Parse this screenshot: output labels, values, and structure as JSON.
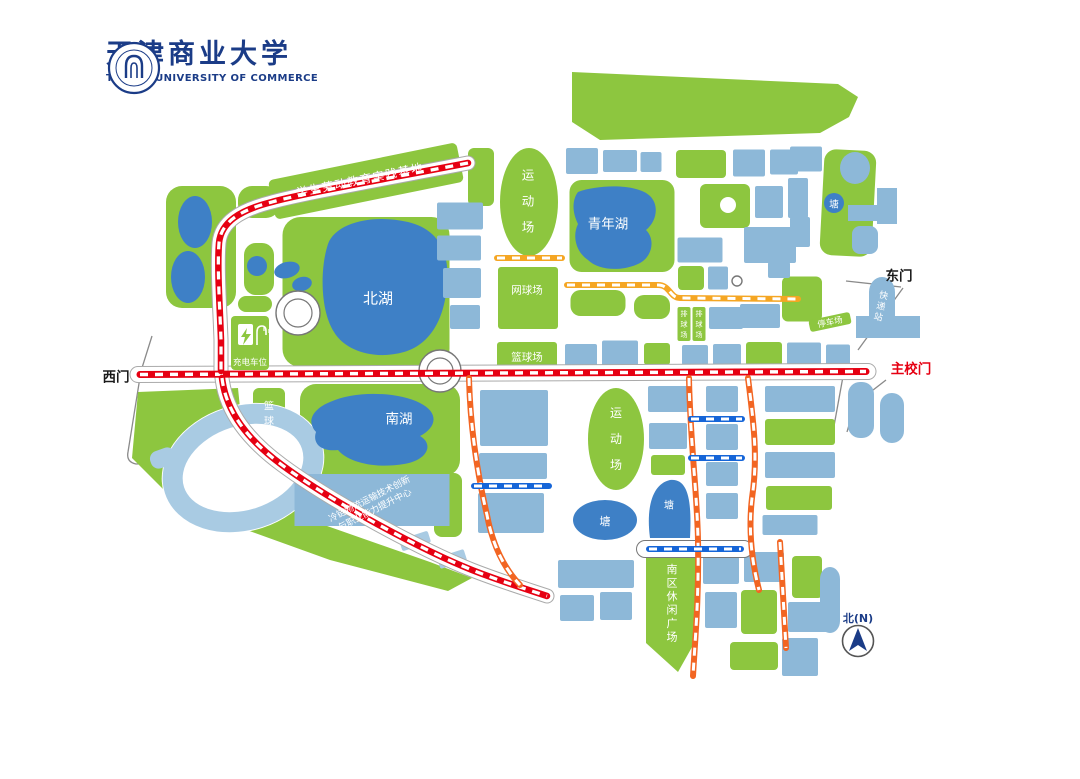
{
  "logo": {
    "title": "天津商业大学",
    "subtitle": "TIANJIN UNIVERSITY OF COMMERCE",
    "color": "#1b3c87"
  },
  "palette": {
    "green": "#8dc63f",
    "building": "#8db8d8",
    "lake": "#3e80c6",
    "lightblue": "#a9cbe3",
    "red": "#e60012",
    "orange": "#f26522",
    "yellow": "#f5a623",
    "routeBlue": "#1565d8",
    "boundary": "#8a8a8a",
    "roadEdge": "#aaaaaa",
    "navy": "#1b3c87",
    "textDark": "#1a1a1a"
  },
  "map": {
    "boundary": [
      "M152,336 L141,371 L128,452 Q126,462 136,464 L166,463",
      "M903,288 L858,350",
      "M846,281 L901,287",
      "M886,380 L855,404 L847,432",
      "M846,360 L834,426"
    ],
    "greens": {
      "polys": [
        "572,72 838,84 858,97 849,117 820,133 600,140 572,122",
        "138,392 238,388 246,468 310,520 430,562 472,578 448,591 330,560 180,506 132,458",
        "646,558 696,558 696,640 678,672 646,643"
      ],
      "rects": [
        [
          201,
          247,
          70,
          122,
          16,
          0
        ],
        [
          259,
          202,
          42,
          32,
          14,
          0
        ],
        [
          259,
          269,
          30,
          52,
          12,
          0
        ],
        [
          255,
          304,
          34,
          16,
          8,
          0
        ],
        [
          366,
          181,
          192,
          40,
          5,
          -11.5
        ],
        [
          481,
          177,
          26,
          58,
          6,
          0
        ],
        [
          366,
          292,
          167,
          150,
          18,
          0
        ],
        [
          528,
          298,
          60,
          62,
          3,
          0
        ],
        [
          527,
          356,
          60,
          28,
          3,
          0
        ],
        [
          622,
          226,
          105,
          92,
          12,
          0
        ],
        [
          598,
          303,
          55,
          26,
          10,
          0
        ],
        [
          652,
          307,
          36,
          24,
          10,
          0
        ],
        [
          269,
          422,
          32,
          68,
          6,
          0
        ],
        [
          380,
          430,
          160,
          92,
          16,
          0
        ],
        [
          448,
          505,
          28,
          64,
          8,
          0
        ],
        [
          725,
          206,
          50,
          44,
          6,
          0
        ],
        [
          691,
          278,
          26,
          24,
          4,
          0
        ],
        [
          802,
          299,
          40,
          45,
          6,
          0
        ],
        [
          848,
          203,
          52,
          106,
          12,
          3
        ],
        [
          701,
          164,
          50,
          28,
          4,
          0
        ],
        [
          657,
          354,
          26,
          22,
          3,
          0
        ],
        [
          764,
          354,
          36,
          24,
          3,
          0
        ],
        [
          668,
          465,
          34,
          20,
          3,
          0
        ],
        [
          800,
          432,
          70,
          26,
          3,
          0
        ],
        [
          799,
          498,
          66,
          24,
          3,
          0
        ],
        [
          807,
          577,
          30,
          42,
          4,
          0
        ],
        [
          759,
          612,
          36,
          44,
          4,
          0
        ],
        [
          754,
          656,
          48,
          28,
          4,
          0
        ]
      ],
      "ellipses": [
        [
          529,
          202,
          29,
          54
        ],
        [
          616,
          439,
          28,
          51
        ]
      ]
    },
    "water": {
      "lakes": [
        "M328,244 C336,222 374,214 408,222 C438,229 450,252 447,284 C445,316 432,344 404,352 C376,360 346,352 334,332 C320,310 320,268 328,244 Z",
        "M330,402 C356,390 398,392 420,403 C440,413 436,428 420,436 C434,444 428,460 404,464 C374,469 348,462 338,450 C322,452 312,444 316,432 C305,420 315,408 330,402 Z",
        "M578,192 C600,184 638,184 650,196 C660,206 656,222 646,230 C656,240 652,258 638,264 C620,272 598,270 588,260 C576,252 572,236 578,224 C572,212 572,200 578,192 Z",
        "M650,538 C646,508 652,484 670,480 C688,478 692,500 690,538 Z"
      ],
      "ellipses": [
        [
          605,
          520,
          32,
          20,
          0
        ],
        [
          195,
          222,
          17,
          26,
          0
        ],
        [
          188,
          277,
          17,
          26,
          0
        ],
        [
          287,
          270,
          13,
          8,
          -15
        ],
        [
          302,
          284,
          10,
          7,
          -15
        ]
      ],
      "circles": [
        [
          834,
          203,
          10
        ],
        [
          257,
          266,
          10
        ]
      ],
      "ringWhite": [
        243,
        468,
        83,
        63,
        -18
      ],
      "ring": {
        "cx": 243,
        "cy": 468,
        "rx": 72,
        "ry": 52,
        "rot": -18,
        "w": 20
      },
      "lightRects": [
        [
          415,
          541,
          30,
          12,
          2,
          -18
        ],
        [
          452,
          559,
          28,
          12,
          2,
          -18
        ],
        [
          163,
          458,
          26,
          18,
          8,
          -20
        ]
      ]
    },
    "whiteCircles": [
      [
        728,
        205,
        8
      ]
    ],
    "buildings": [
      [
        460,
        216,
        46,
        27
      ],
      [
        459,
        248,
        44,
        25
      ],
      [
        462,
        283,
        38,
        30
      ],
      [
        465,
        317,
        30,
        24
      ],
      [
        582,
        161,
        32,
        26
      ],
      [
        620,
        161,
        34,
        22
      ],
      [
        651,
        162,
        21,
        20
      ],
      [
        749,
        163,
        32,
        27
      ],
      [
        784,
        162,
        28,
        25
      ],
      [
        769,
        202,
        28,
        32
      ],
      [
        798,
        198,
        20,
        40
      ],
      [
        770,
        245,
        52,
        36
      ],
      [
        700,
        250,
        45,
        25
      ],
      [
        718,
        278,
        20,
        23
      ],
      [
        779,
        270,
        22,
        16
      ],
      [
        726,
        318,
        34,
        22
      ],
      [
        760,
        316,
        40,
        24
      ],
      [
        806,
        159,
        32,
        25
      ],
      [
        800,
        232,
        20,
        30
      ],
      [
        855,
        168,
        30,
        32,
        20
      ],
      [
        866,
        213,
        36,
        16,
        -18
      ],
      [
        865,
        240,
        26,
        28,
        8
      ],
      [
        887,
        206,
        20,
        36,
        0
      ],
      [
        581,
        355,
        32,
        22
      ],
      [
        620,
        353,
        36,
        25
      ],
      [
        695,
        355,
        26,
        20
      ],
      [
        727,
        355,
        28,
        22
      ],
      [
        804,
        354,
        34,
        23
      ],
      [
        838,
        355,
        24,
        21
      ],
      [
        514,
        418,
        68,
        56
      ],
      [
        513,
        466,
        68,
        26
      ],
      [
        511,
        513,
        66,
        40
      ],
      [
        668,
        399,
        40,
        26
      ],
      [
        668,
        436,
        38,
        26
      ],
      [
        722,
        399,
        32,
        26
      ],
      [
        722,
        437,
        32,
        26
      ],
      [
        722,
        474,
        32,
        24
      ],
      [
        722,
        506,
        32,
        26
      ],
      [
        800,
        399,
        70,
        26
      ],
      [
        800,
        465,
        70,
        26
      ],
      [
        790,
        525,
        55,
        20
      ],
      [
        861,
        410,
        26,
        56,
        12
      ],
      [
        892,
        418,
        24,
        50,
        12
      ],
      [
        888,
        327,
        64,
        22,
        -38
      ],
      [
        596,
        574,
        76,
        28
      ],
      [
        577,
        608,
        34,
        26
      ],
      [
        616,
        606,
        32,
        28
      ],
      [
        721,
        570,
        36,
        28
      ],
      [
        764,
        567,
        40,
        30
      ],
      [
        721,
        610,
        32,
        36
      ],
      [
        808,
        617,
        40,
        30
      ],
      [
        800,
        657,
        36,
        38
      ],
      [
        830,
        600,
        20,
        66,
        12
      ],
      [
        882,
        306,
        26,
        58,
        15
      ]
    ],
    "roads": [
      {
        "d": "M138,374.5 L868,371.5",
        "w": 15
      },
      {
        "d": "M468,163 C380,180 300,194 272,202 C240,210 221,222 219,243 C217,268 220,310 221,340 L221,371",
        "w": 13
      },
      {
        "d": "M222,378 C226,412 248,440 282,465 C332,502 422,550 472,570 C500,581 526,589 547,596",
        "w": 13
      },
      {
        "d": "M645,549 L744,549",
        "w": 16,
        "edge": "#777777"
      }
    ],
    "roundabouts": [
      [
        298,
        313,
        22,
        14
      ],
      [
        440,
        371,
        21,
        13
      ],
      [
        737,
        281,
        5,
        0
      ]
    ],
    "routes": [
      {
        "d": "M140,374.5 L866,371.5",
        "c": "red",
        "w": 7
      },
      {
        "d": "M468,163 C380,180 300,194 272,202 C240,210 221,222 219,243 C217,268 220,310 221,340 L221,371",
        "c": "red",
        "w": 6.5
      },
      {
        "d": "M222,378 C226,412 248,440 282,465 C332,502 422,550 472,570 C500,581 526,589 547,596",
        "c": "red",
        "w": 6.5
      },
      {
        "d": "M469,378 C470,420 476,468 487,515 C492,542 502,566 520,585",
        "c": "orange",
        "w": 6
      },
      {
        "d": "M689,378 C690,440 697,490 698,540 C699,600 695,640 693,676",
        "c": "orange",
        "w": 6
      },
      {
        "d": "M748,378 C754,425 758,458 752,498 C748,532 752,562 759,590",
        "c": "orange",
        "w": 6
      },
      {
        "d": "M780,542 L786,648",
        "c": "orange",
        "w": 6
      },
      {
        "d": "M497,258 L562,258",
        "c": "yellow",
        "w": 6
      },
      {
        "d": "M567,285 L658,285 C670,285 670,298 680,298 L798,299",
        "c": "yellow",
        "w": 6
      },
      {
        "d": "M474,486 L549,486",
        "c": "routeBlue",
        "w": 6
      },
      {
        "d": "M691,419 L742,419",
        "c": "routeBlue",
        "w": 6
      },
      {
        "d": "M691,458 L742,458",
        "c": "routeBlue",
        "w": 6
      },
      {
        "d": "M649,549 L741,549",
        "c": "routeBlue",
        "w": 6
      }
    ],
    "badges": [
      [
        830,
        322,
        42,
        12,
        3,
        -12
      ],
      [
        684,
        324,
        13,
        34,
        2,
        0
      ],
      [
        699,
        324,
        13,
        34,
        2,
        0
      ],
      [
        250,
        343,
        38,
        54,
        4,
        0
      ]
    ],
    "labels": [
      {
        "n": "west-gate-label",
        "t": "西门",
        "x": 116,
        "y": 377,
        "s": 13.5,
        "c": "#1a1a1a",
        "b": 1
      },
      {
        "n": "east-gate-label",
        "t": "东门",
        "x": 899,
        "y": 276,
        "s": 13.5,
        "c": "#1a1a1a",
        "b": 1
      },
      {
        "n": "main-gate-label",
        "t": "主校门",
        "x": 911,
        "y": 369,
        "s": 13.5,
        "c": "#e60012",
        "b": 1
      },
      {
        "n": "north-lake-label",
        "t": "北湖",
        "x": 378,
        "y": 298,
        "s": 15,
        "c": "#ffffff"
      },
      {
        "n": "south-lake-label",
        "t": "南湖",
        "x": 399,
        "y": 419,
        "s": 13.5,
        "c": "#ffffff"
      },
      {
        "n": "youth-lake-label",
        "t": "青年湖",
        "x": 608,
        "y": 224,
        "s": 13.5,
        "c": "#ffffff"
      },
      {
        "n": "sports-field-north-label",
        "t": "运动场",
        "x": 528,
        "y": 201,
        "s": 12.5,
        "c": "#ffffff",
        "v": 1,
        "st": 26
      },
      {
        "n": "sports-field-south-label",
        "t": "运动场",
        "x": 616,
        "y": 439,
        "s": 12,
        "c": "#ffffff",
        "v": 1,
        "st": 26
      },
      {
        "n": "tennis-court-label",
        "t": "网球场",
        "x": 527,
        "y": 290,
        "s": 10.5,
        "c": "#ffffff"
      },
      {
        "n": "basketball-court-center-label",
        "t": "篮球场",
        "x": 527,
        "y": 357,
        "s": 10.5,
        "c": "#ffffff"
      },
      {
        "n": "basketball-court-west-label",
        "t": "篮球场",
        "x": 269,
        "y": 421,
        "s": 10,
        "c": "#ffffff",
        "v": 1,
        "st": 15
      },
      {
        "n": "pond-northeast-label",
        "t": "塘",
        "x": 834,
        "y": 204,
        "s": 9.5,
        "c": "#ffffff"
      },
      {
        "n": "pond-south-label",
        "t": "塘",
        "x": 605,
        "y": 521,
        "s": 11,
        "c": "#ffffff"
      },
      {
        "n": "pond-southeast-label",
        "t": "塘",
        "x": 669,
        "y": 505,
        "s": 10,
        "c": "#ffffff"
      },
      {
        "n": "parking-lot-label",
        "t": "停车场",
        "x": 830,
        "y": 322,
        "s": 8.5,
        "c": "#ffffff",
        "r": -12
      },
      {
        "n": "express-station-label",
        "t": "快递站",
        "x": 881,
        "y": 306,
        "s": 9,
        "c": "#ffffff",
        "v": 1,
        "st": 11,
        "r": 14
      },
      {
        "n": "charging-space-label",
        "t": "充电车位",
        "x": 250,
        "y": 362,
        "s": 8.5,
        "c": "#ffffff"
      },
      {
        "n": "labor-education-base-label",
        "t": "学生劳动教育实践基地",
        "x": 360,
        "y": 180,
        "s": 11.5,
        "c": "#ffffff",
        "r": -11.5,
        "ls": 1.5
      },
      {
        "n": "cold-chain-center-label",
        "t": "冷链物流运输技术创新与职业能力提升中心",
        "x": 372,
        "y": 504,
        "s": 9,
        "c": "#ffffff",
        "r": -27,
        "lines": [
          "冷链物流运输技术创新",
          "与职业能力提升中心"
        ],
        "lh": 12
      },
      {
        "n": "south-plaza-label",
        "t": "南区休闲广场",
        "x": 672,
        "y": 603,
        "s": 11,
        "c": "#ffffff",
        "v": 1,
        "st": 13.5
      },
      {
        "n": "volleyball-court-1-label",
        "t": "排球场",
        "x": 684,
        "y": 324,
        "s": 7,
        "c": "#ffffff",
        "v": 1,
        "st": 10.5
      },
      {
        "n": "volleyball-court-2-label",
        "t": "排球场",
        "x": 699,
        "y": 324,
        "s": 7,
        "c": "#ffffff",
        "v": 1,
        "st": 10.5
      },
      {
        "n": "compass-north-label",
        "t": "北(N)",
        "x": 858,
        "y": 618,
        "s": 11,
        "c": "#1b3c87",
        "b": 1
      }
    ],
    "coldChainBuilding": [
      372,
      500,
      155,
      52,
      -27
    ],
    "extras": [
      {
        "el": "rect",
        "n": "charging-station-icon",
        "x": 238,
        "y": 324,
        "width": 15,
        "height": 21,
        "rx": 2,
        "fill": "#ffffff"
      },
      {
        "el": "polygon",
        "n": "lightning-icon",
        "points": "247,328 241,337 245,337 243,345 251,334 246,334",
        "fill": "#8dc63f"
      },
      {
        "el": "path",
        "n": "charging-cable-icon",
        "d": "M257,345 V332 q0,-6 5,-6 q4,0 4,5 v4",
        "stroke": "#ffffff",
        "stroke-width": "1.6",
        "fill": "none"
      },
      {
        "el": "path",
        "n": "charging-plug-icon",
        "d": "M264,331 v-4 M269,333 v-4",
        "stroke": "#ffffff",
        "stroke-width": "1.2",
        "fill": "none"
      },
      {
        "el": "circle",
        "n": "compass-circle",
        "cx": 858,
        "cy": 641,
        "r": 15.5,
        "fill": "#ffffff",
        "stroke": "#555555",
        "stroke-width": "1.6"
      },
      {
        "el": "polygon",
        "n": "compass-arrow-icon",
        "points": "858,628 867,651 858,645 849,651",
        "fill": "#1b3c87"
      }
    ]
  }
}
